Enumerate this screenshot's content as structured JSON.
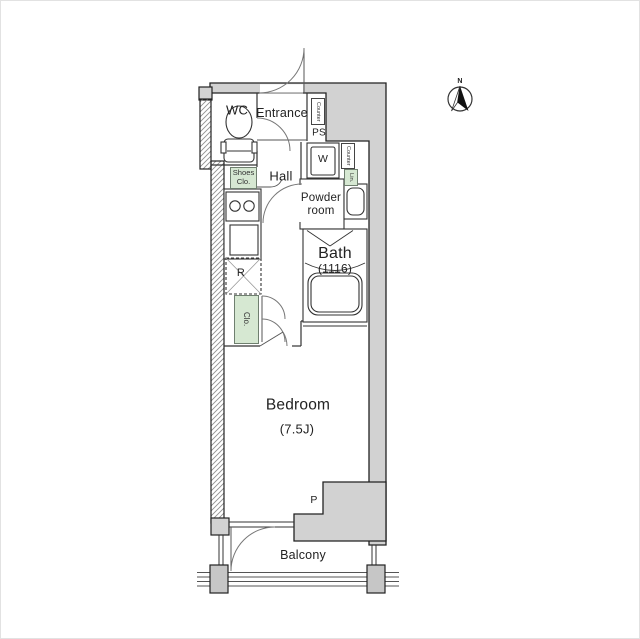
{
  "floor_plan": {
    "rooms": {
      "wc": "WC",
      "entrance": "Entrance",
      "hall": "Hall",
      "powder_room": "Powder room",
      "bath": "Bath",
      "bath_size": "(1116)",
      "bedroom": "Bedroom",
      "bedroom_size": "(7.5J)",
      "balcony": "Balcony"
    },
    "fixtures": {
      "counter_top": "Counter",
      "pipe_space": "PS",
      "washer": "W",
      "counter_side": "Counter",
      "linen": "Lin.",
      "shoes_closet": "Shoes Clo.",
      "refrigerator": "R",
      "closet": "Clo."
    },
    "annotations": {
      "pillar": "P",
      "north": "N"
    },
    "colors": {
      "wall_fill": "#d2d2d2",
      "post_fill": "#c6c6c6",
      "closet_fill": "#d6e8d2",
      "outline": "#222222",
      "thin_line": "#333333"
    }
  }
}
